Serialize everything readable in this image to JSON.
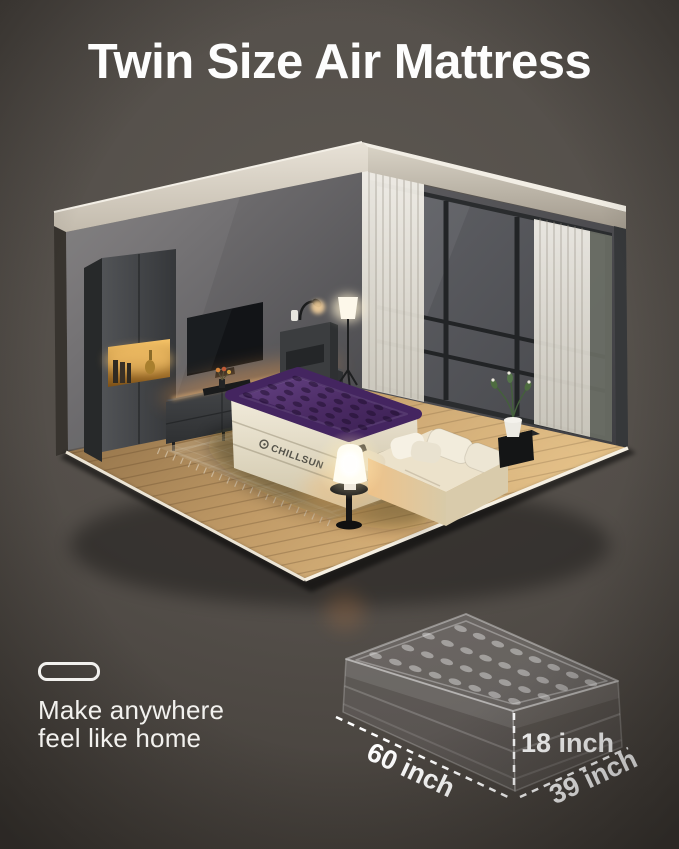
{
  "title": "Twin Size Air Mattress",
  "tagline": {
    "icon": "air-mattress-icon",
    "line1": "Make anywhere",
    "line2": "feel like home"
  },
  "mattress": {
    "brand": "CHILLSUN",
    "top_color": "#4a2a63",
    "base_color": "#e9e1cd"
  },
  "dimensions": {
    "length": "60 inch",
    "height": "18 inch",
    "width": "39 inch"
  },
  "colors": {
    "background": "#534e49",
    "title_text": "#fdfdfd",
    "tagline_text": "#f2f1ee",
    "dimension_text": "#ffffff",
    "accent_glow": "#f0a95c",
    "wood_floor": "#c9a46f"
  }
}
